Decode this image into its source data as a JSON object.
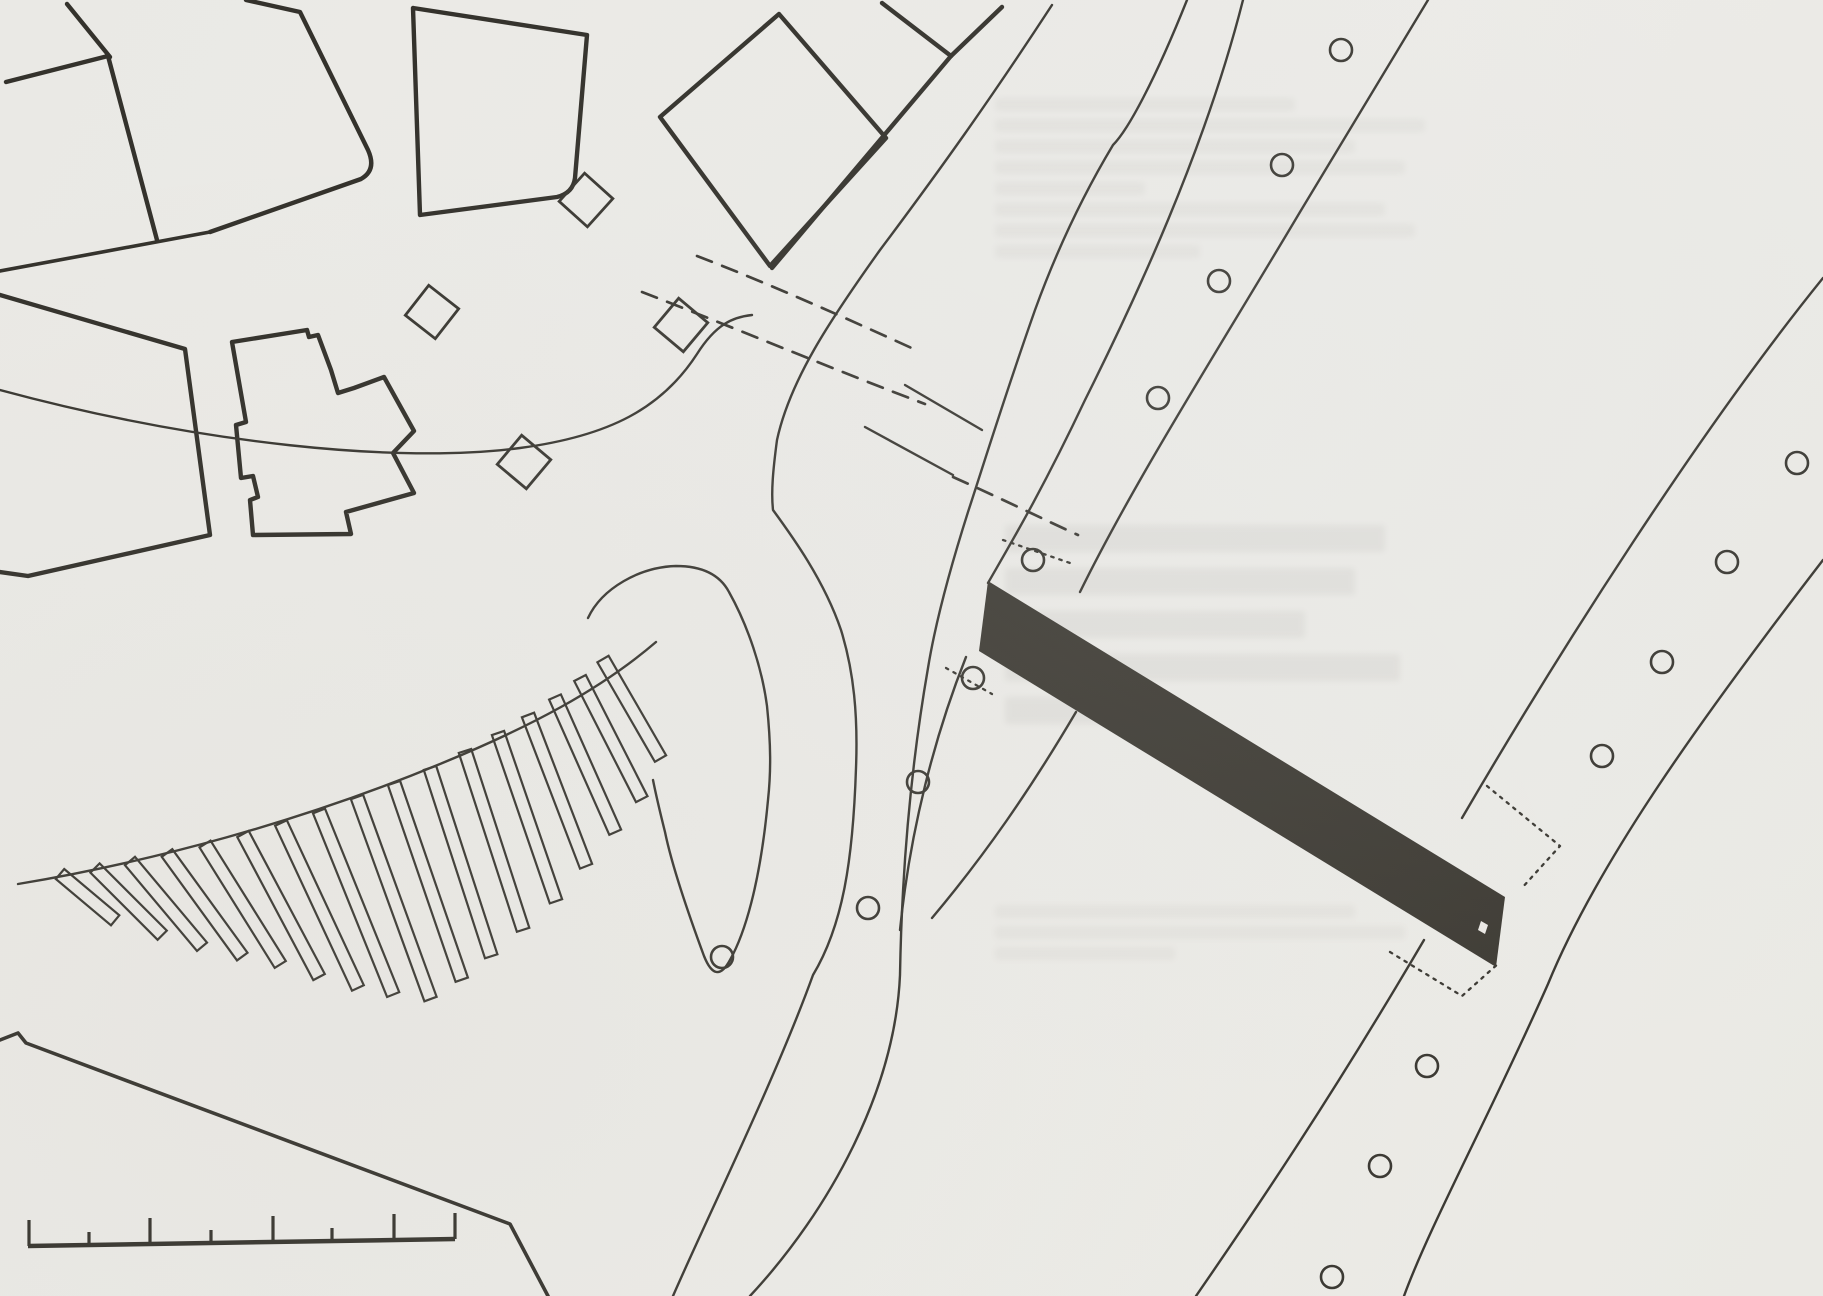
{
  "document": {
    "kind": "scanned-site-plan",
    "canvas": {
      "width": 1823,
      "height": 1296
    },
    "colors": {
      "paper": "#ebe9e5",
      "ink": "#34322c",
      "ink_thin": "#3a3832",
      "bar": "#3e3b34",
      "bleed": "#6a675e"
    }
  },
  "layers": [
    {
      "name": "buildings",
      "width": 4.4,
      "paths": [
        "M67,4 L110,57",
        "M6,82 L108,56 L157,240",
        "M246,0 L300,12 L368,150 Q377,170 361,179 L210,232",
        "M413,8 L587,35 L575,178 Q573,193 557,197 L420,215 L413,8",
        "M779,14 L886,138 L770,266 L660,117 Z",
        "M882,3 L951,56",
        "M1002,7 L951,56",
        "M951,56 L772,268",
        "M0,295 L185,349 L210,535 L28,576 L0,572",
        "M232,342 L307,330 L309,337 L318,335 L331,370 L338,393 L354,388 L384,377 L414,431 L393,453 L414,493 L346,512 L351,534 L253,535 L250,500 L258,497 L253,476 L241,478 L236,425 L246,422 Z"
      ]
    },
    {
      "name": "street-edges-heavy",
      "width": 3.6,
      "paths": [
        "M0,271 L210,232",
        "M0,1040 L18,1033 L26,1043 L510,1224 L548,1296"
      ]
    },
    {
      "name": "roads",
      "width": 2.4,
      "paths": [
        "M0,390 C200,444 400,464 520,448 C610,436 662,408 697,354 C716,324 733,317 752,315",
        "M1052,5 C990,100 940,170 880,250 C830,320 790,380 777,440 C773,470 771,492 773,510 C792,536 824,580 841,630 C854,672 858,716 856,768 C853,860 843,925 813,975 C775,1080 706,1220 673,1296",
        "M1187,0 C1155,80 1128,130 1113,145 C1080,200 1055,255 1035,310 C1005,395 985,460 968,512 C948,575 935,625 928,668 C912,760 902,860 900,975 C895,1090 830,1210 750,1296",
        "M1243,0 C1205,150 1135,300 1085,400 C1040,495 1008,548 988,583",
        "M966,657 C935,735 910,830 900,930",
        "M1428,0 L1300,212 C1218,350 1135,480 1080,592",
        "M1076,712 C1030,790 985,855 932,918",
        "M1823,278 C1700,430 1560,650 1462,818",
        "M1424,940 C1330,1100 1252,1215 1196,1296",
        "M1823,560 C1700,720 1598,862 1548,984 C1490,1115 1430,1225 1404,1296",
        "M588,618 C602,588 640,567 676,566 C702,566 720,575 729,592 C748,626 762,668 767,706 C771,745 771,772 768,800 C760,886 744,935 730,960 Q716,986 704,956 C687,910 672,866 665,832 C660,812 656,795 653,780",
        "M18,884 C150,862 300,822 440,764 C530,727 600,690 656,642",
        "M905,385 L982,430",
        "M865,427 L953,475"
      ]
    },
    {
      "name": "dashed-crossings",
      "width": 2.7,
      "dash": "16 11",
      "paths": [
        "M642,292 C740,330 840,372 925,404",
        "M697,256 C770,284 850,320 916,350",
        "M953,477 C1000,498 1045,520 1078,535"
      ]
    },
    {
      "name": "dotted-marks",
      "width": 2.3,
      "dash": "2.5 6",
      "paths": [
        "M1003,540 L1070,563",
        "M946,668 L992,694",
        "M1487,786 L1560,846 L1521,889",
        "M1390,952 L1462,996 L1500,962"
      ]
    }
  ],
  "bridge_bar": {
    "polygon": "M988,581 L1505,897 L1496,967 L979,651 Z",
    "notch": "M1481,921 L1488,925 L1485,934 L1478,930 Z"
  },
  "tree_circles": {
    "radius": 11,
    "stroke_width": 2.6,
    "centers": [
      [
        1341,
        50
      ],
      [
        1282,
        165
      ],
      [
        1219,
        281
      ],
      [
        1158,
        398
      ],
      [
        1033,
        560
      ],
      [
        973,
        678
      ],
      [
        918,
        782
      ],
      [
        868,
        908
      ],
      [
        722,
        957
      ],
      [
        1797,
        463
      ],
      [
        1727,
        562
      ],
      [
        1662,
        662
      ],
      [
        1602,
        756
      ],
      [
        1427,
        1066
      ],
      [
        1380,
        1166
      ],
      [
        1332,
        1277
      ]
    ]
  },
  "kiosk_squares": {
    "size": 38,
    "stroke_width": 2.8,
    "items": [
      [
        432,
        312,
        38
      ],
      [
        524,
        462,
        40
      ],
      [
        586,
        200,
        42
      ],
      [
        681,
        325,
        40
      ]
    ]
  },
  "pier_strips": {
    "width": 13,
    "stroke_width": 2.2,
    "items": [
      [
        60,
        874,
        50,
        72
      ],
      [
        95,
        868,
        45,
        95
      ],
      [
        130,
        861,
        40,
        112
      ],
      [
        167,
        853,
        36,
        128
      ],
      [
        205,
        844,
        32,
        142
      ],
      [
        243,
        834,
        28,
        162
      ],
      [
        281,
        823,
        25,
        182
      ],
      [
        319,
        811,
        22,
        198
      ],
      [
        357,
        797,
        20,
        215
      ],
      [
        394,
        783,
        19,
        208
      ],
      [
        430,
        768,
        18,
        198
      ],
      [
        465,
        751,
        18,
        188
      ],
      [
        498,
        733,
        19,
        178
      ],
      [
        528,
        715,
        21,
        162
      ],
      [
        555,
        697,
        24,
        148
      ],
      [
        580,
        678,
        27,
        136
      ],
      [
        603,
        659,
        30,
        115
      ]
    ]
  },
  "scale_bar": {
    "baseline": "M28,1246 L455,1239",
    "baseline_width": 4.5,
    "tick_width": 3.2,
    "tall_ticks": [
      [
        29,
        1246
      ],
      [
        150,
        1244
      ],
      [
        273,
        1242
      ],
      [
        394,
        1240
      ],
      [
        455,
        1239
      ]
    ],
    "tall_length": 26,
    "short_ticks": [
      [
        89,
        1245
      ],
      [
        211,
        1243
      ],
      [
        332,
        1241
      ]
    ],
    "short_length": 13
  },
  "bleedthrough_regions": [
    {
      "x": 995,
      "y": 98,
      "row_height": 13,
      "gap": 21,
      "opacity": 0.055,
      "row_widths": [
        300,
        430,
        360,
        410,
        150,
        390,
        420,
        205
      ]
    },
    {
      "x": 1005,
      "y": 525,
      "row_height": 27,
      "gap": 43,
      "opacity": 0.075,
      "row_widths": [
        380,
        350,
        300,
        395,
        165
      ]
    },
    {
      "x": 995,
      "y": 905,
      "row_height": 13,
      "gap": 21,
      "opacity": 0.05,
      "row_widths": [
        360,
        410,
        180
      ]
    }
  ]
}
